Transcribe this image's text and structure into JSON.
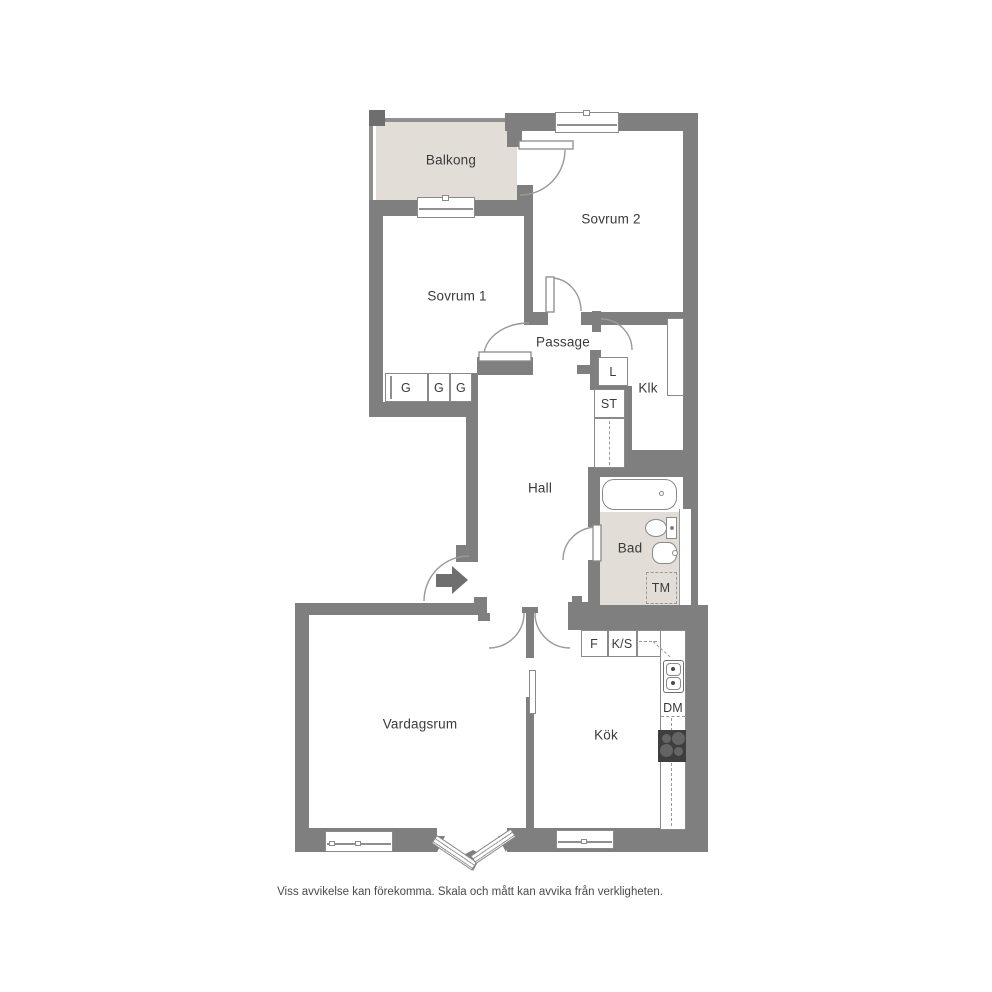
{
  "floorplan": {
    "title": "Apartment floor plan (2 rooms and kitchen)",
    "rooms": {
      "balkong": "Balkong",
      "sovrum2": "Sovrum 2",
      "sovrum1": "Sovrum 1",
      "passage": "Passage",
      "klk": "Klk",
      "hall": "Hall",
      "bad": "Bad",
      "vardagsrum": "Vardagsrum",
      "kok": "Kök"
    },
    "closets": {
      "g1": "G",
      "g2": "G",
      "g3": "G",
      "l": "L",
      "st": "ST"
    },
    "appliances": {
      "tm": "TM",
      "f": "F",
      "ks": "K/S",
      "dm": "DM"
    },
    "disclaimer": "Viss avvikelse kan förekomma. Skala och mått kan avvika från verkligheten.",
    "colors": {
      "wall": "#7f7f7f",
      "accent_floor": "#e2ded7",
      "outline": "#8a8a8a",
      "text": "#3a3a3a",
      "stove": "#3e3e3e"
    }
  }
}
